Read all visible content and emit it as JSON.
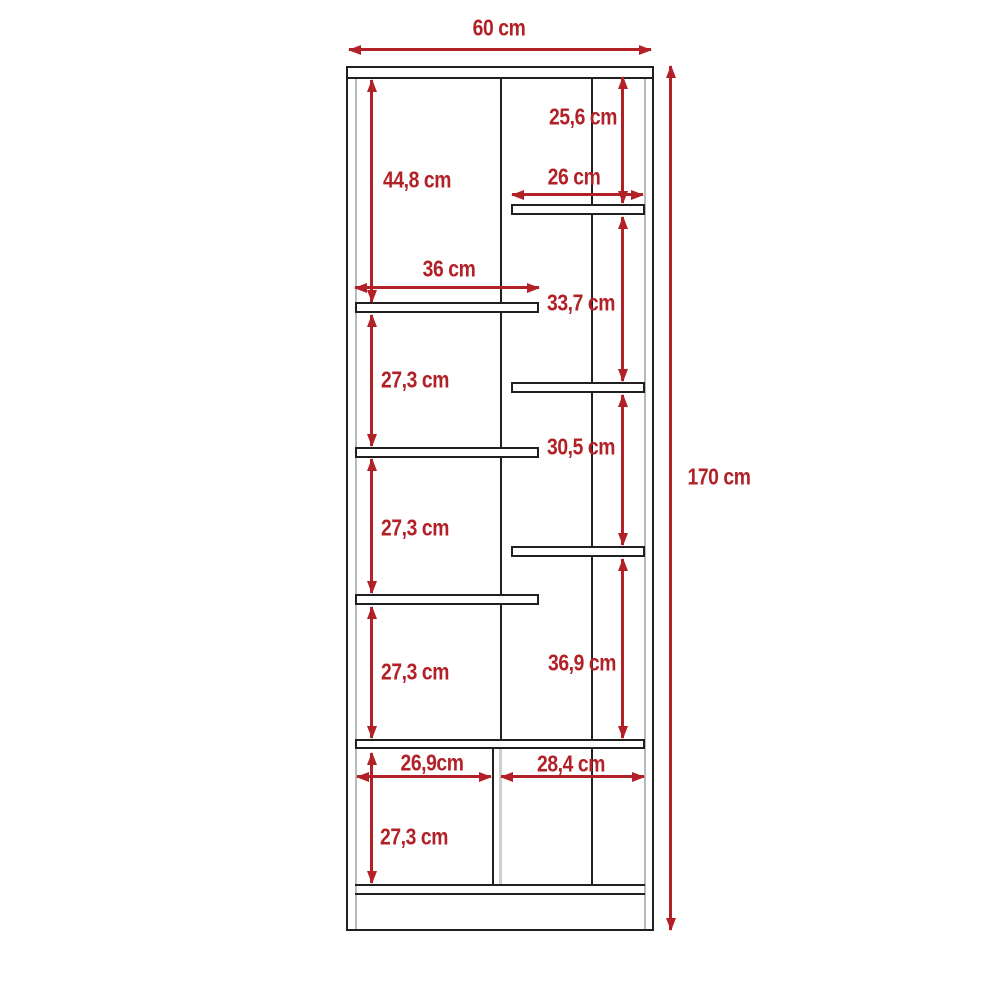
{
  "colors": {
    "dimension_red": "#b22127",
    "outline_black": "#231f20",
    "inner_line_gray": "#b9b9b9"
  },
  "dimensions": {
    "total_width": "60 cm",
    "total_height": "170 cm",
    "right_section_1": "25,6 cm",
    "left_section_1": "44,8 cm",
    "right_shelf_width": "26 cm",
    "left_shelf_width": "36 cm",
    "right_section_2": "33,7 cm",
    "left_section_2": "27,3 cm",
    "right_section_3": "30,5 cm",
    "left_section_3": "27,3 cm",
    "right_section_4": "36,9 cm",
    "left_section_4": "27,3 cm",
    "bottom_left_width": "26,9cm",
    "bottom_right_width": "28,4 cm",
    "bottom_section_height": "27,3 cm"
  }
}
